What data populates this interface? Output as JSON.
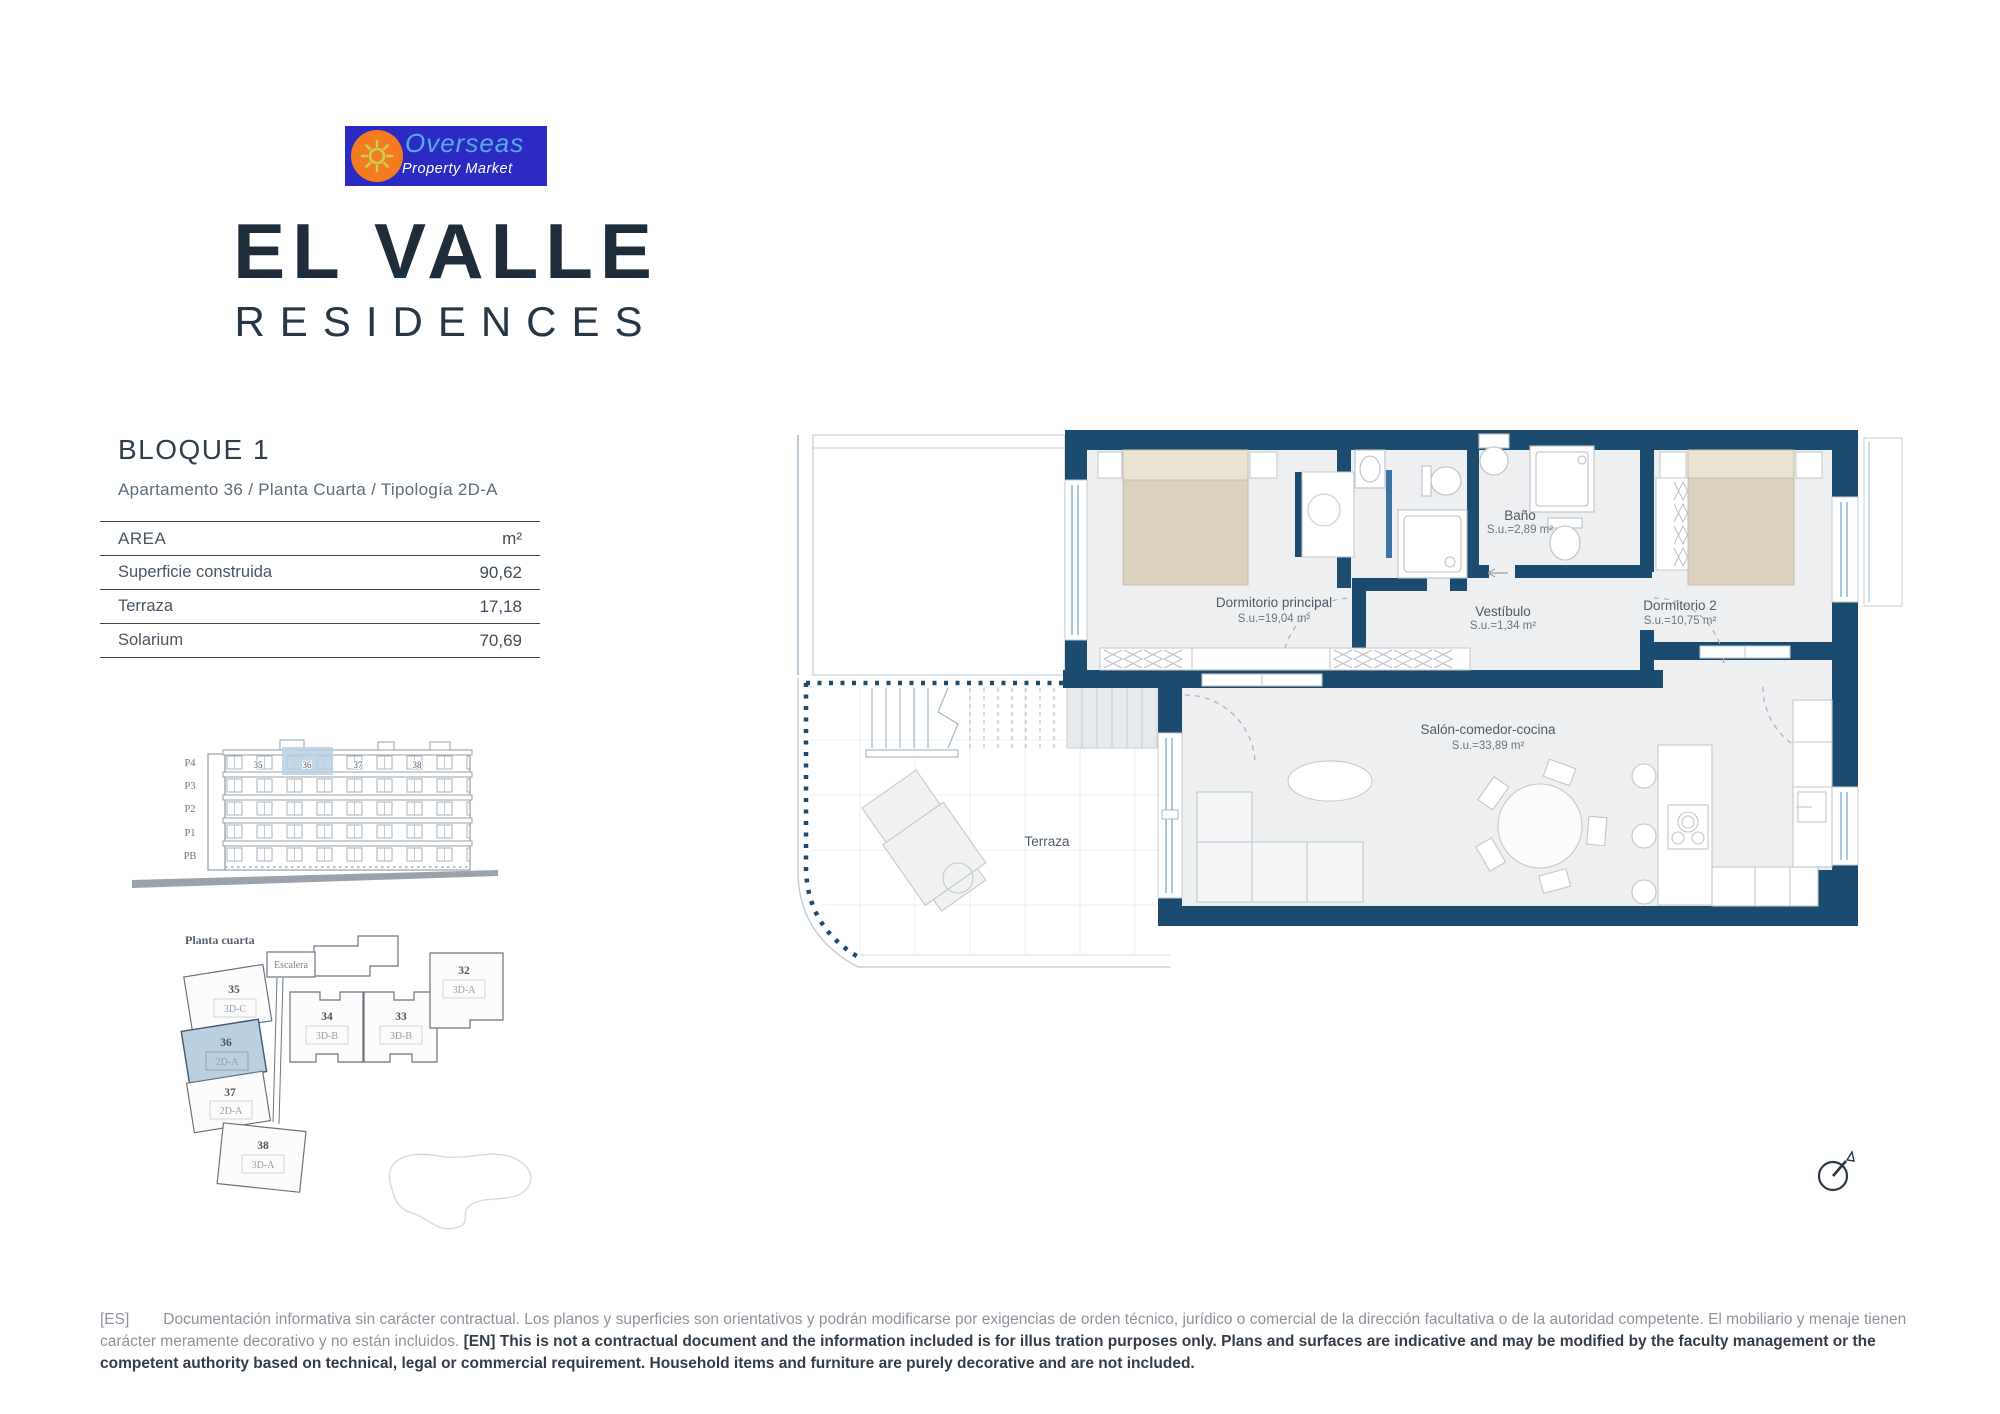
{
  "logo": {
    "line1": "Overseas",
    "line2": "Property Market",
    "bg_color": "#2b2ac2",
    "sun_color": "#f47b20",
    "ray_color": "#c6d449",
    "line1_color": "#58aae6",
    "line2_color": "#ffffff"
  },
  "brand": {
    "title": "EL VALLE",
    "subtitle": "RESIDENCES",
    "color": "#1f2c3a"
  },
  "header": {
    "block": "BLOQUE 1",
    "apartment_line": "Apartamento 36 / Planta Cuarta / Tipología 2D-A"
  },
  "area_table": {
    "header": {
      "label": "AREA",
      "unit": "m²"
    },
    "rows": [
      {
        "label": "Superficie construida",
        "value": "90,62"
      },
      {
        "label": "Terraza",
        "value": "17,18"
      },
      {
        "label": "Solarium",
        "value": "70,69"
      }
    ]
  },
  "elevation": {
    "floors": [
      "P4",
      "P3",
      "P2",
      "P1",
      "PB"
    ],
    "units": [
      "35",
      "36",
      "37",
      "38"
    ],
    "highlight_color": "#b9d0e2"
  },
  "site_plan": {
    "title": "Planta cuarta",
    "stair_label": "Escalera",
    "highlight_color": "#b9d0e2",
    "units": [
      {
        "number": "35",
        "type": "3D-C"
      },
      {
        "number": "36",
        "type": "2D-A",
        "highlighted": "true"
      },
      {
        "number": "37",
        "type": "2D-A"
      },
      {
        "number": "38",
        "type": "3D-A"
      },
      {
        "number": "34",
        "type": "3D-B"
      },
      {
        "number": "33",
        "type": "3D-B"
      },
      {
        "number": "32",
        "type": "3D-A"
      }
    ]
  },
  "floor_plan": {
    "wall_color": "#1b4b6e",
    "rooms": [
      {
        "name": "Dormitorio principal",
        "area": "S.u.=19,04 m²"
      },
      {
        "name": "Baño",
        "area": "S.u.=2,89 m²"
      },
      {
        "name": "Vestíbulo",
        "area": "S.u.=1,34 m²"
      },
      {
        "name": "Dormitorio 2",
        "area": "S.u.=10,75 m²"
      },
      {
        "name": "Salón-comedor-cocina",
        "area": "S.u.=33,89 m²"
      },
      {
        "name": "Terraza",
        "area": ""
      }
    ]
  },
  "disclaimer": {
    "es_tag": "[ES]",
    "es_text": "Documentación informativa sin carácter contractual. Los planos y superficies son orientativos y podrán modificarse por exigencias de orden técnico, jurídico o comercial de la dirección facultativa o de la autoridad competente. El mobiliario y menaje tienen carácter meramente decorativo y no están incluidos. ",
    "en_tag": "[EN]",
    "en_text": " This is not a contractual document and the information included is for illus tration purposes only. Plans and surfaces are indicative and may be modified by the faculty management or the competent authority based on technical, legal or commercial requirement. Household items and furniture are purely decorative and are not included."
  }
}
